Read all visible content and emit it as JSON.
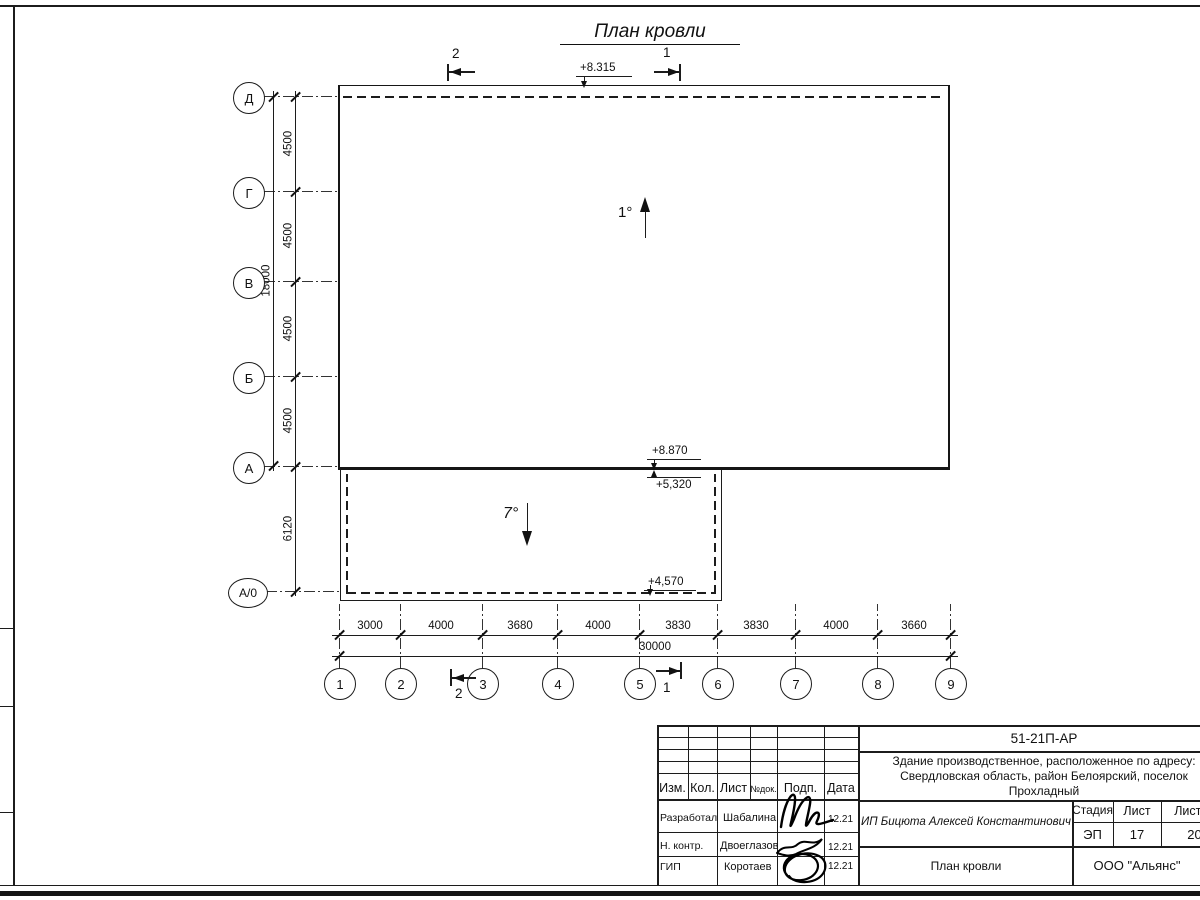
{
  "plan": {
    "title": "План кровли",
    "slopes": {
      "main": "1°",
      "annex": "7°"
    },
    "elevations": {
      "roof_top": "+8.315",
      "roof_main": "+8.870",
      "annex_high": "+5,320",
      "annex_low": "+4,570"
    },
    "sections": {
      "s1": "1",
      "s2": "2"
    },
    "row_axes": [
      "Д",
      "Г",
      "В",
      "Б",
      "А",
      "А/0"
    ],
    "row_dims": [
      "4500",
      "4500",
      "4500",
      "4500",
      "6120"
    ],
    "row_total": "18000",
    "col_axes": [
      "1",
      "2",
      "3",
      "4",
      "5",
      "6",
      "7",
      "8",
      "9"
    ],
    "col_dims": [
      "3000",
      "4000",
      "3680",
      "4000",
      "3830",
      "3830",
      "4000",
      "3660"
    ],
    "col_total": "30000"
  },
  "titleblock": {
    "doc_number": "51-21П-АР",
    "project_desc_line1": "Здание производственное, расположенное по адресу:",
    "project_desc_line2": "Свердловская область, район Белоярский, поселок",
    "project_desc_line3": "Прохладный",
    "client": "ИП Бицюта Алексей Константинович",
    "stage_label": "Стадия",
    "stage": "ЭП",
    "sheet_label": "Лист",
    "sheet": "17",
    "sheets_label": "Листов",
    "sheets": "20",
    "sheet_title": "План кровли",
    "company": "ООО \"Альянс\"",
    "header_cols": [
      "Изм.",
      "Кол.",
      "Лист",
      "№док.",
      "Подп.",
      "Дата"
    ],
    "rows": [
      {
        "role": "Разработал",
        "name": "Шабалина",
        "date": "12.21"
      },
      {
        "role": "Н. контр.",
        "name": "Двоеглазов",
        "date": "12.21"
      },
      {
        "role": "ГИП",
        "name": "Коротаев",
        "date": "12.21"
      }
    ]
  }
}
